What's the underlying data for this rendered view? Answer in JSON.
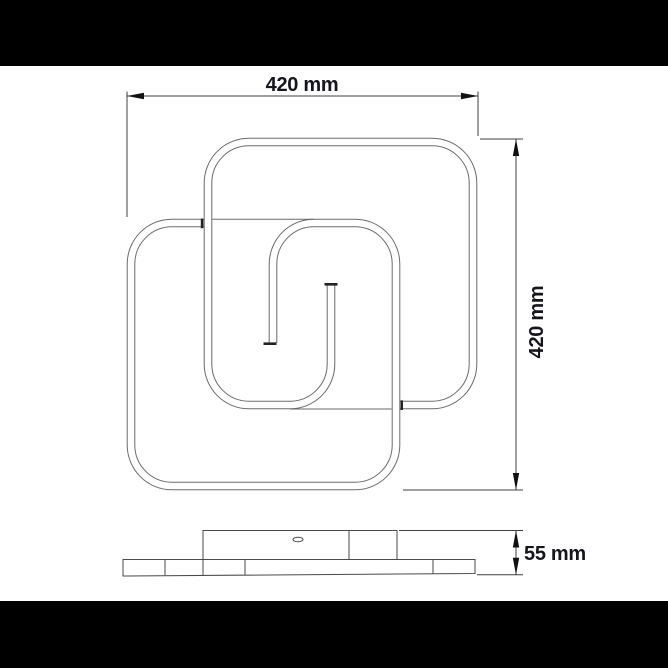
{
  "page": {
    "background": "#ffffff",
    "letterbox_color": "#000000"
  },
  "drawing": {
    "dimensions": {
      "width_label": "420 mm",
      "height_label": "420 mm",
      "depth_label": "55 mm"
    },
    "colors": {
      "fixture_line": "#6a6a6a",
      "dimension_line": "#3f3f3f",
      "arrow_and_caps": "#111111",
      "text": "#15151c"
    }
  }
}
